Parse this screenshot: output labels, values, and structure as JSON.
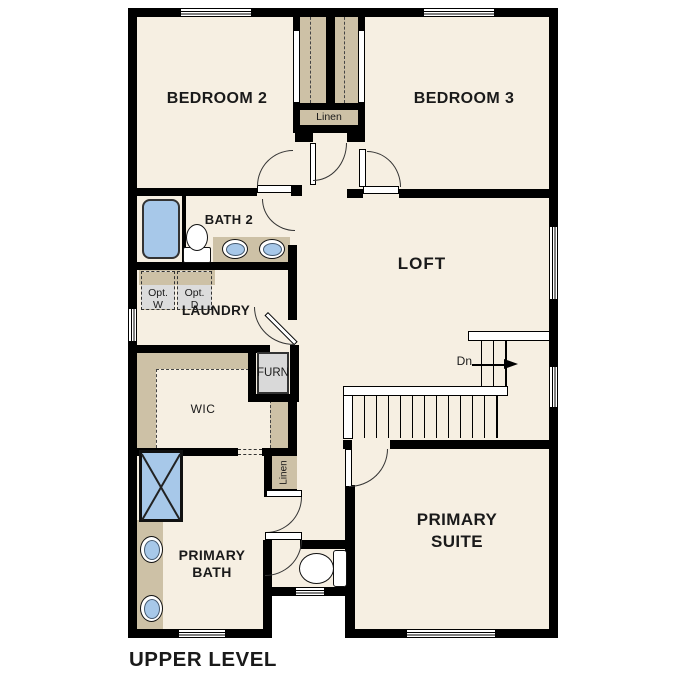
{
  "title": "UPPER LEVEL",
  "rooms": {
    "bedroom2": "BEDROOM 2",
    "bedroom3": "BEDROOM 3",
    "bath2": "BATH 2",
    "laundry": "LAUNDRY",
    "loft": "LOFT",
    "wic": "WIC",
    "furnace": "FURN",
    "linen_upper": "Linen",
    "linen_lower": "Linen",
    "primary_bath": "PRIMARY\nBATH",
    "primary_suite": "PRIMARY\nSUITE"
  },
  "labels": {
    "opt_washer": "Opt.\nW",
    "opt_dryer": "Opt.\nD",
    "stairs_down": "Dn"
  },
  "colors": {
    "floor": "#F6EFE2",
    "wall": "#000000",
    "millwork_tan": "#CDC1A6",
    "fixture_blue": "#A7C8E9",
    "appliance_gray": "#DCDCDC",
    "text": "#1A1A1A"
  }
}
